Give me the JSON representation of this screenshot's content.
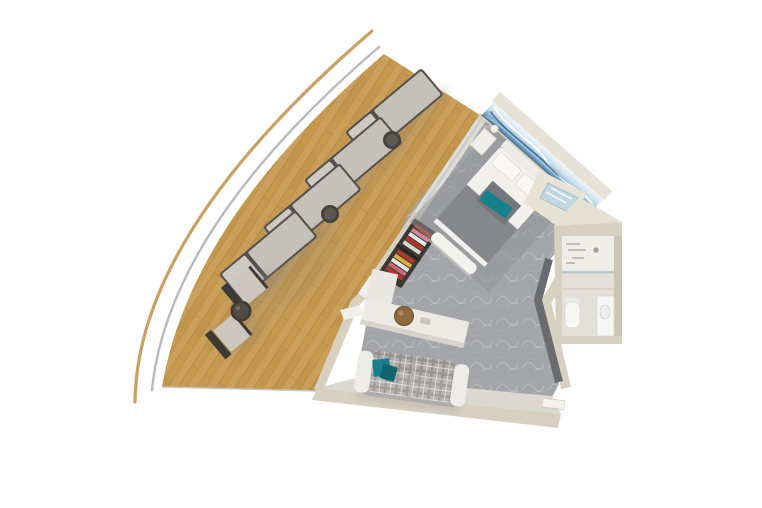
{
  "canvas": {
    "width": 762,
    "height": 508,
    "background": "#FFFFFF"
  },
  "scene": {
    "kind": "3D cutaway floor plan, top-down render",
    "setting": "ship balcony suite with wrap-around teak deck",
    "rooms": [
      {
        "id": "balcony",
        "name": "wrap-around balcony deck",
        "furniture": [
          "sun lounger x4",
          "round side table x2",
          "deck chair x2",
          "round cocktail table x1"
        ]
      },
      {
        "id": "bedroom",
        "name": "bedroom",
        "furniture": [
          "double bed with gray runner and teal throw",
          "nightstand x2",
          "foot bench",
          "wave-mural headboard wall",
          "open wardrobe with clothes"
        ]
      },
      {
        "id": "living",
        "name": "living area",
        "furniture": [
          "plaid sofa with teal pillows",
          "desk",
          "round wooden stool"
        ]
      },
      {
        "id": "bathroom",
        "name": "bathroom",
        "furniture": [
          "shower with skylight",
          "toilet",
          "vanity sink"
        ]
      },
      {
        "id": "entry",
        "name": "entry",
        "furniture": [
          "door sill"
        ]
      }
    ]
  },
  "colors": {
    "hull": "#C8A164",
    "deck_edge": "#ABADB0",
    "deck": "#C6994F",
    "plank_seam": "#A8793C",
    "wall": "#D7D0C1",
    "wall_light": "#E7E2D5",
    "wall_face": "#DBD8D0",
    "carpet": "#A3A5A9",
    "rug": "#8F9195",
    "bed_white": "#F1F0ED",
    "bed_runner": "#85878A",
    "teal": "#17808D",
    "teal_dark": "#11636E",
    "art_blue": "#4E7FA8",
    "lounger_cushion": "#C6C3BA",
    "lounger_frame": "#555150",
    "table_dark": "#46423E",
    "chair_frame": "#3C3936",
    "sofa_fabric": "#AFADA9",
    "sofa_white": "#EDECE9",
    "stool": "#8C693E",
    "panel_dark": "#696B6D",
    "bath_floor": "#E3E0D9",
    "fixture": "#F6F6F4",
    "glass": "#BFD8E4",
    "shadow": "#8D857A"
  }
}
